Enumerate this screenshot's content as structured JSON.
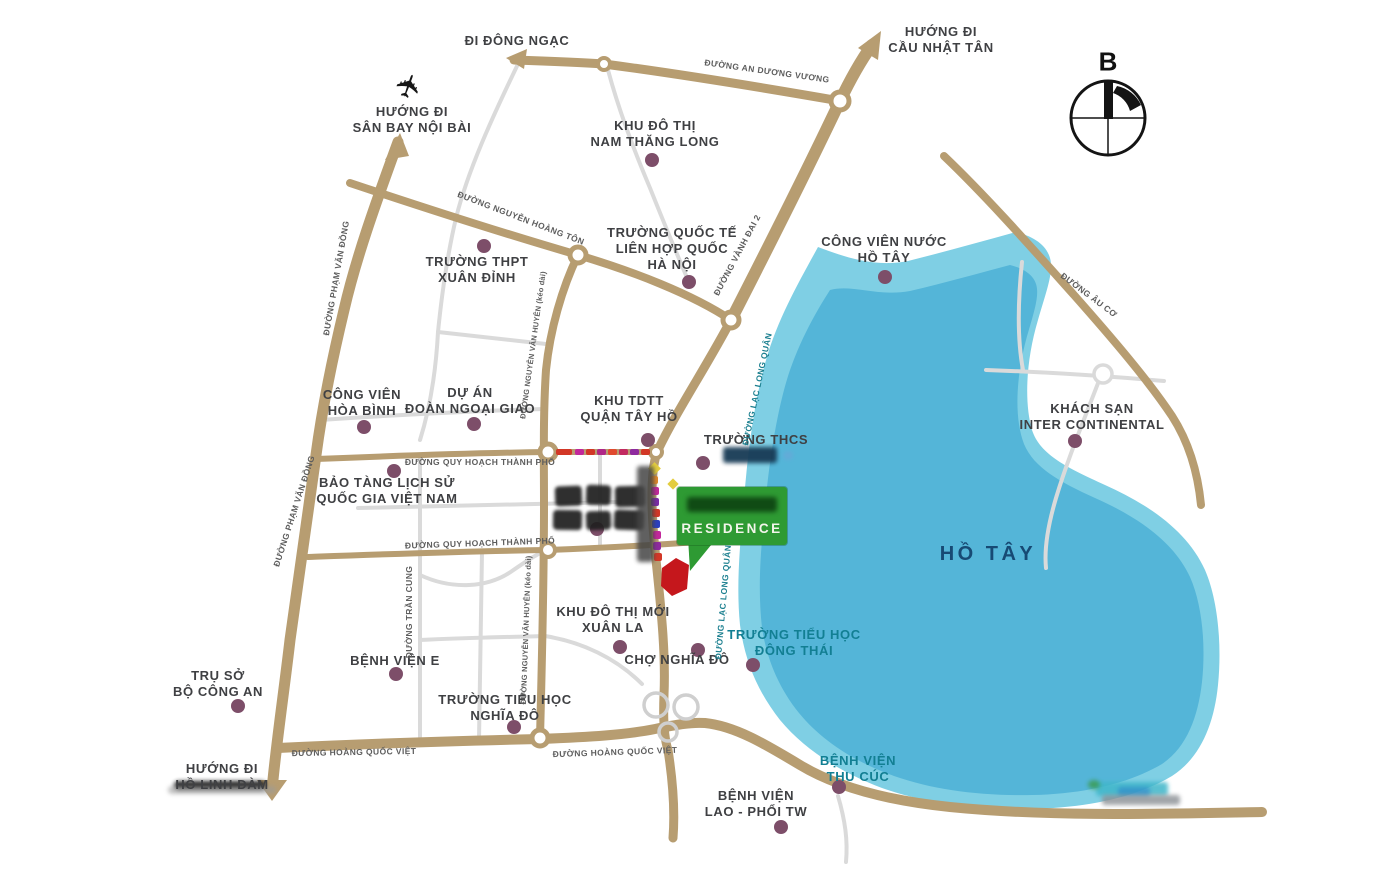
{
  "directions": {
    "dong_ngac": "ĐI ĐÔNG NGẠC",
    "san_bay_noi_bai": "HƯỚNG ĐI\nSÂN BAY NỘI BÀI",
    "cau_nhat_tan": "HƯỚNG ĐI\nCẦU NHẬT TÂN",
    "ho_linh_dam": "HƯỚNG ĐI\nHỒ LINH ĐÀM"
  },
  "places": {
    "khu_do_thi_nam_thang_long": "KHU ĐÔ THỊ\nNAM THĂNG LONG",
    "truong_quoc_te": "TRƯỜNG QUỐC TẾ\nLIÊN HỢP QUỐC\nHÀ NỘI",
    "cong_vien_nuoc_ho_tay": "CÔNG VIÊN NƯỚC\nHỒ TÂY",
    "truong_thpt_xuan_dinh": "TRƯỜNG THPT\nXUÂN ĐỈNH",
    "khach_san_intercontinental": "KHÁCH SẠN\nINTER CONTINENTAL",
    "cong_vien_hoa_binh": "CÔNG VIÊN\nHÒA BÌNH",
    "du_an_doan_ngoai_giao": "DỰ ÁN\nĐOÀN NGOẠI GIAO",
    "khu_tdtt_quan_tay_ho": "KHU TDTT\nQUẬN TÂY HỒ",
    "truong_thcs": "TRƯỜNG THCS",
    "bao_tang_lich_su": "BẢO TÀNG LỊCH SỬ\nQUỐC GIA VIỆT NAM",
    "ho_tay": "HỒ TÂY",
    "khu_do_thi_moi_xuan_la": "KHU ĐÔ THỊ MỚI\nXUÂN LA",
    "benh_vien_e": "BỆNH VIỆN E",
    "cho_nghia_do": "CHỢ NGHĨA ĐÔ",
    "truong_tieu_hoc_dong_thai": "TRƯỜNG TIỂU HỌC\nĐÔNG THÁI",
    "tru_so_bo_cong_an": "TRỤ SỞ\nBỘ CÔNG AN",
    "truong_tieu_hoc_nghia_do": "TRƯỜNG TIỂU HỌC\nNGHĨA ĐÔ",
    "benh_vien_thu_cuc": "BỆNH VIỆN\nTHU CÚC",
    "benh_vien_lao_phoi": "BỆNH VIỆN\nLAO - PHỔI TW"
  },
  "roads": {
    "an_duong_vuong": "ĐƯỜNG AN DƯƠNG VƯƠNG",
    "nguyen_hoang_ton": "ĐƯỜNG NGUYỄN HOÀNG TÔN",
    "pham_van_dong": "ĐƯỜNG PHẠM VĂN ĐỒNG",
    "vanh_dai_2": "ĐƯỜNG VÀNH ĐAI 2",
    "lac_long_quan": "ĐƯỜNG LẠC LONG QUÂN",
    "nguyen_van_huyen": "ĐƯỜNG NGUYỄN VĂN HUYÊN (kéo dài)",
    "quy_hoach_thanh_pho": "ĐƯỜNG QUY HOẠCH THÀNH PHỐ",
    "tran_cung": "ĐƯỜNG TRẦN CUNG",
    "hoang_quoc_viet": "ĐƯỜNG HOÀNG QUỐC VIỆT",
    "au_co": "ĐƯỜNG ÂU CƠ"
  },
  "project": {
    "sign_label": "RESIDENCE"
  },
  "compass": {
    "north": "B"
  },
  "icons": {
    "airplane": "✈"
  },
  "colors": {
    "road_tan": "#b79d71",
    "road_gray": "#dadada",
    "lake_outer": "#7fcfe4",
    "lake_inner": "#54b5d8",
    "poi_dot": "#7d4e69",
    "label_dark": "#3f4043",
    "label_teal": "#127f93",
    "lake_text": "#174a74",
    "sign_green": "#2e9a33",
    "site_red": "#c5171c"
  }
}
